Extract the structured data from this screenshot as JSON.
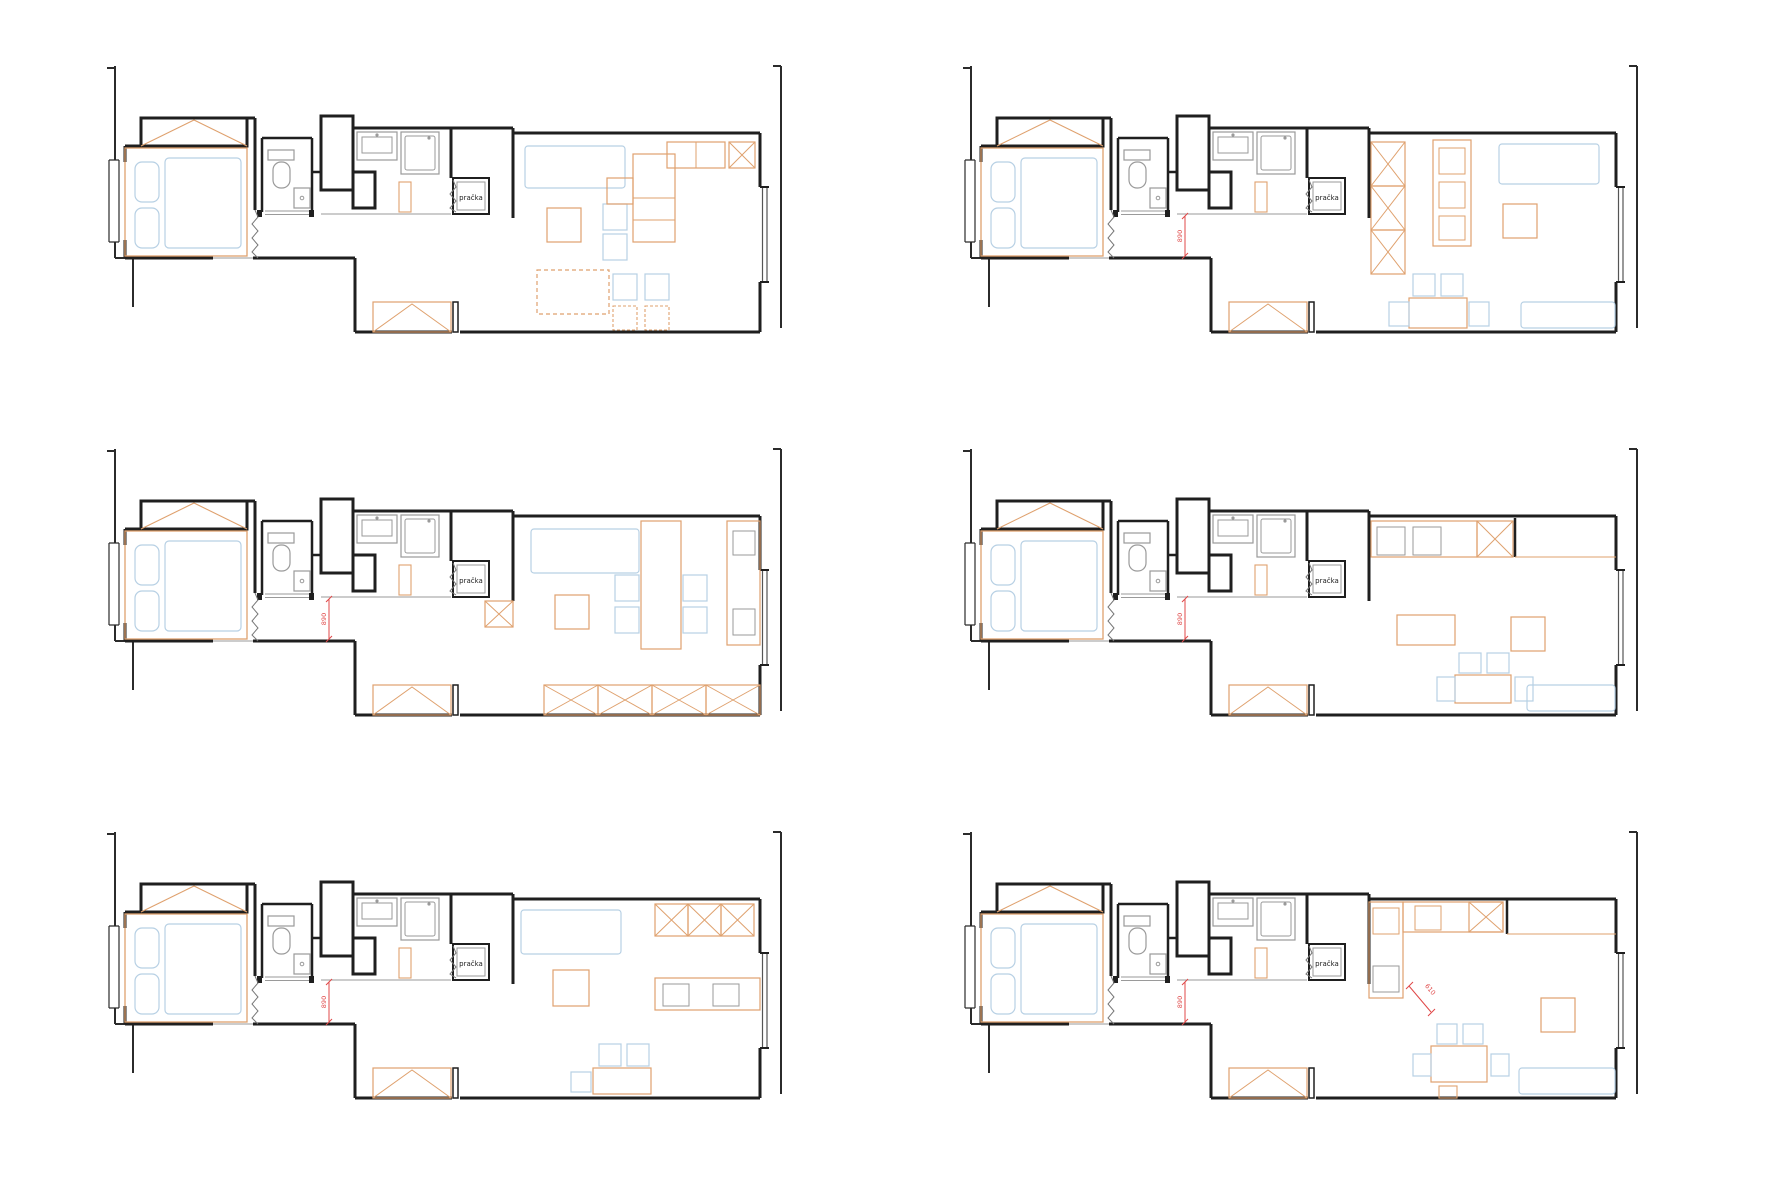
{
  "page": {
    "background": "#ffffff",
    "description": "Six layout variants of a narrow studio apartment floor plan"
  },
  "colors": {
    "wall": "#1f1f1f",
    "context": "#2b2b2b",
    "furniture": "#dfa16e",
    "fixture": "#9a9a9a",
    "soft": "#b7d0e4",
    "dimension": "#e04848"
  },
  "plans": [
    {
      "id": 1,
      "name": "variant-1",
      "washer_label": "pračka",
      "dim_hall": null,
      "dim_kitchen": null
    },
    {
      "id": 2,
      "name": "variant-2",
      "washer_label": "pračka",
      "dim_hall": "890",
      "dim_kitchen": null
    },
    {
      "id": 3,
      "name": "variant-3",
      "washer_label": "pračka",
      "dim_hall": "890",
      "dim_kitchen": null
    },
    {
      "id": 4,
      "name": "variant-4",
      "washer_label": "pračka",
      "dim_hall": "890",
      "dim_kitchen": null
    },
    {
      "id": 5,
      "name": "variant-5",
      "washer_label": "pračka",
      "dim_hall": "890",
      "dim_kitchen": null
    },
    {
      "id": 6,
      "name": "variant-6",
      "washer_label": "pračka",
      "dim_hall": "890",
      "dim_kitchen": "610"
    }
  ]
}
